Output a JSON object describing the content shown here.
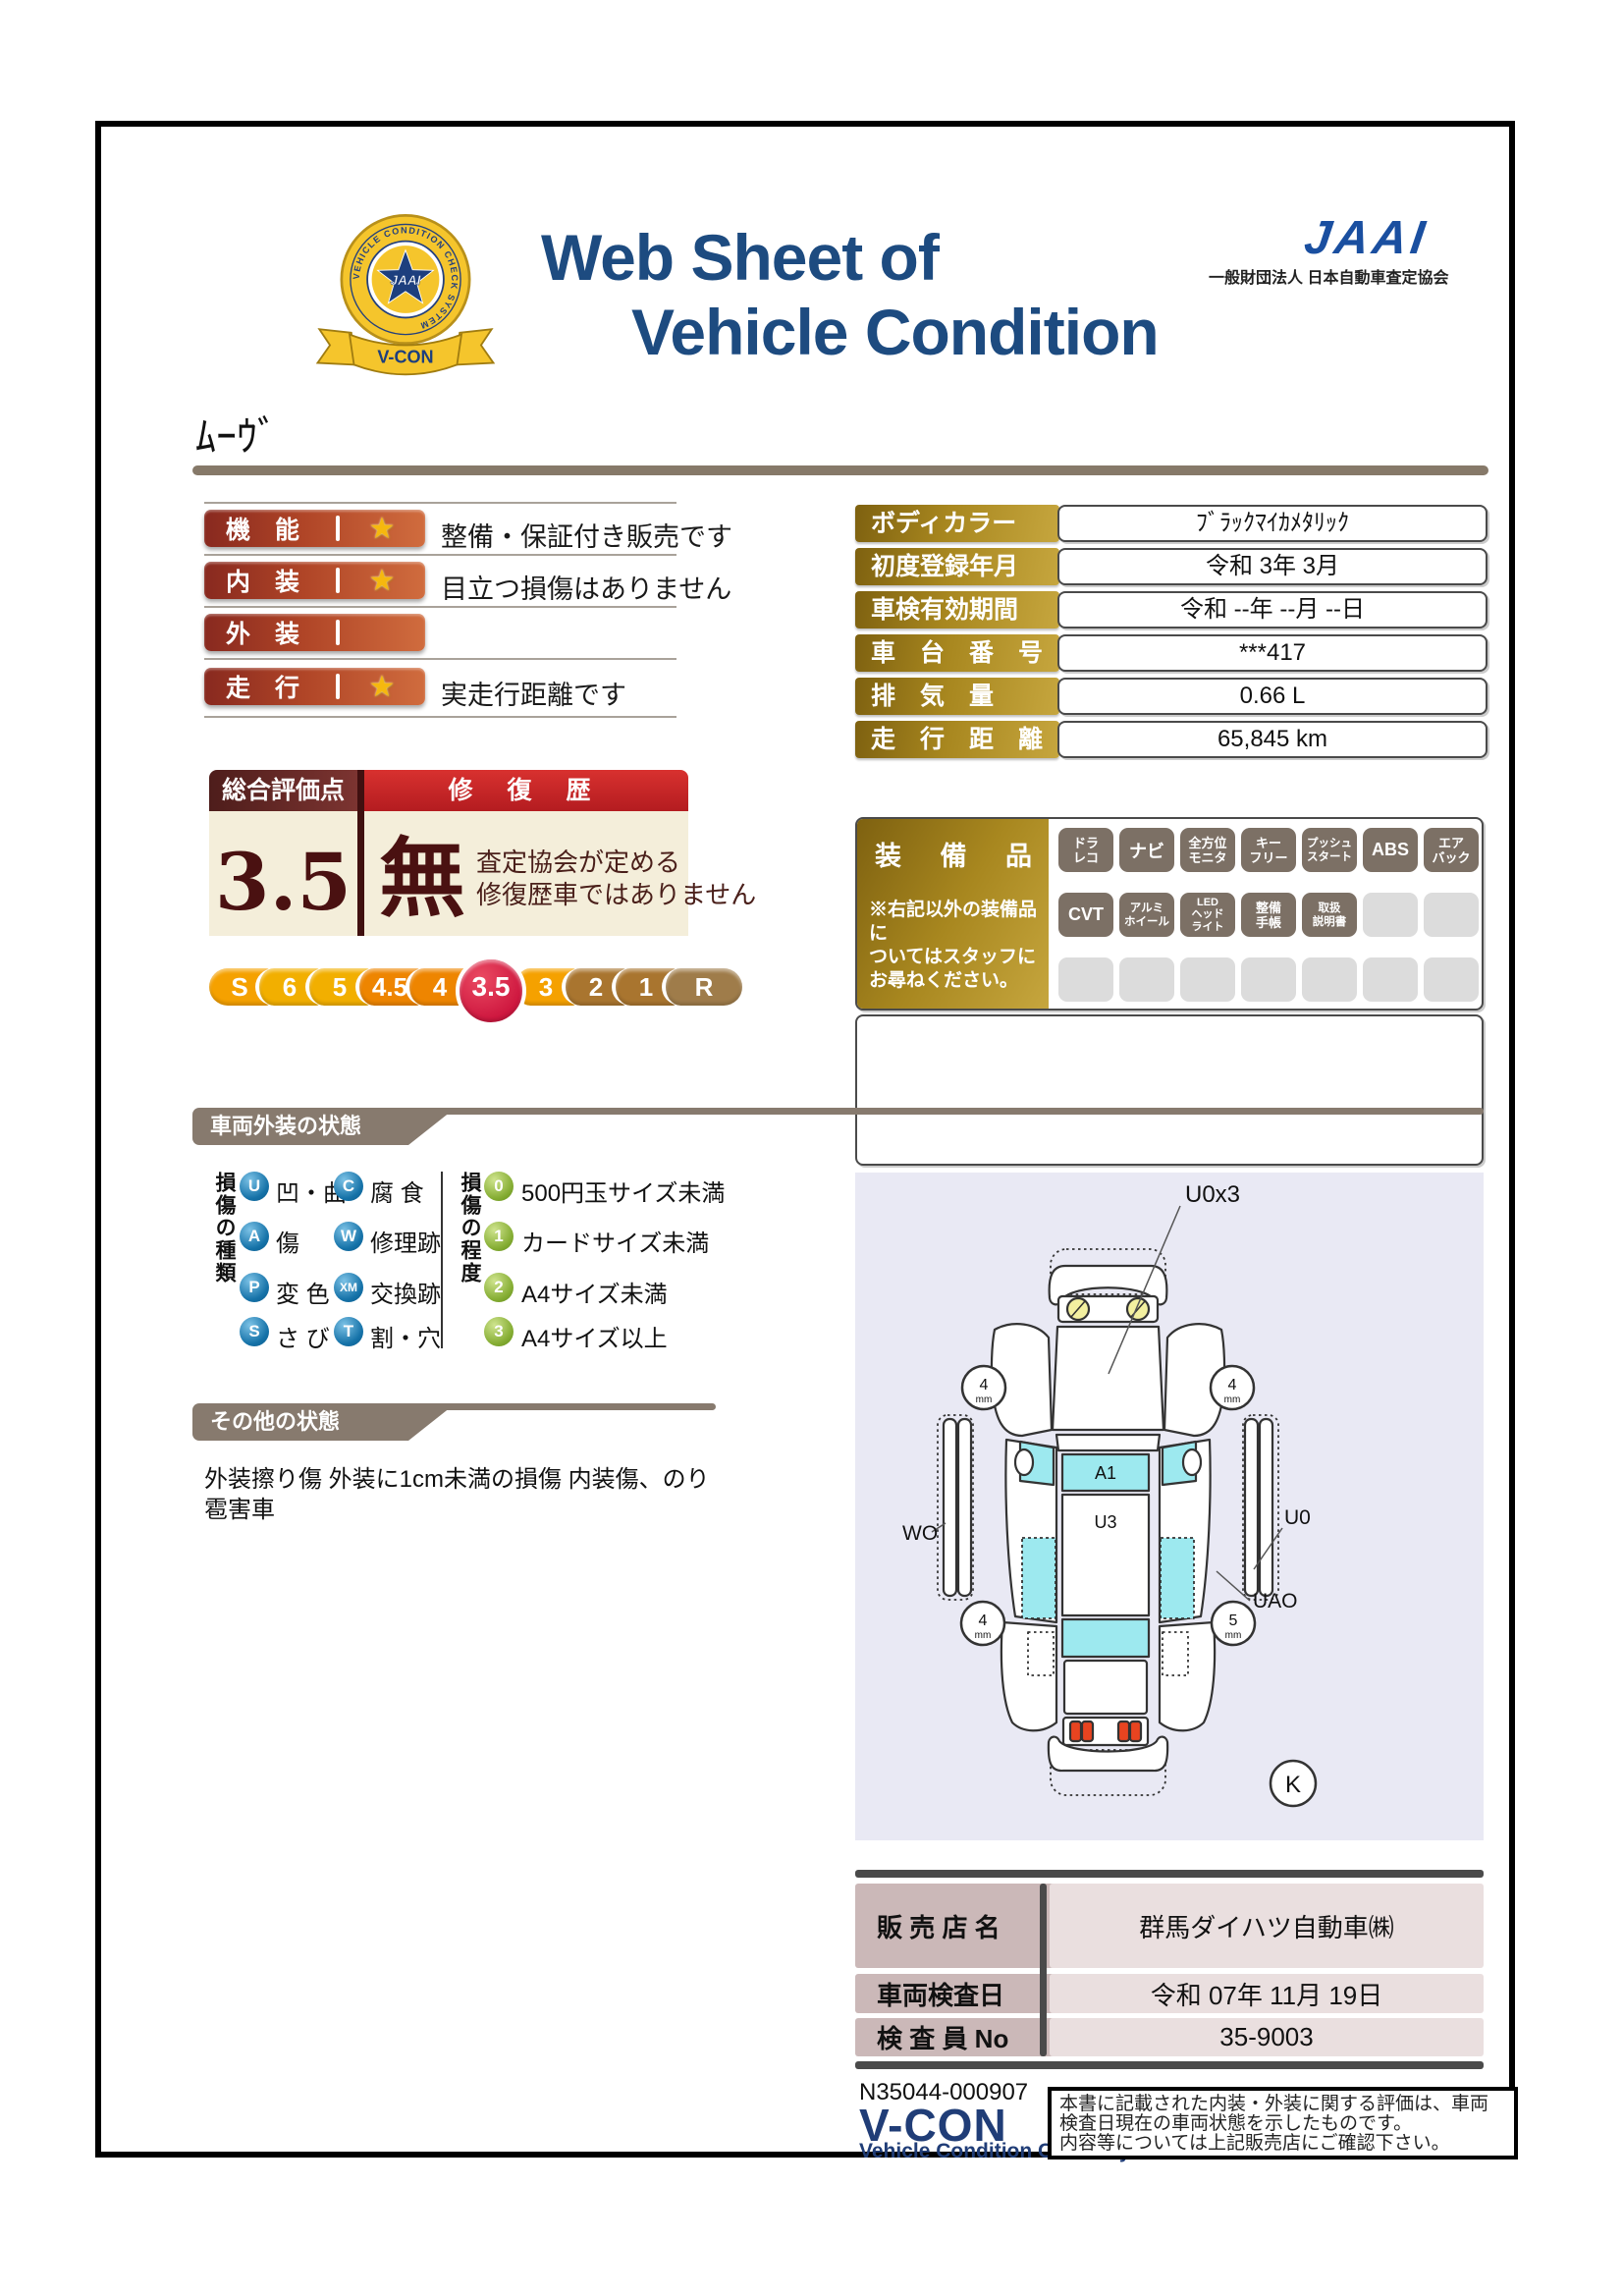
{
  "header": {
    "title1": "Web Sheet of",
    "title2": "Vehicle Condition",
    "jaai_name": "JAAI",
    "jaai_subtitle": "一般財団法人 日本自動車査定協会",
    "emblem": {
      "ring_text": "VEHICLE CONDITION CHECK SYSTEM",
      "center": "JAAI",
      "ribbon": "V-CON"
    }
  },
  "vehicle_name": "ﾑｰｳﾞ",
  "ratings": [
    {
      "label": "機　能",
      "star": "★",
      "description": "整備・保証付き販売です"
    },
    {
      "label": "内　装",
      "star": "★",
      "description": "目立つ損傷はありません"
    },
    {
      "label": "外　装",
      "star": "",
      "description": ""
    },
    {
      "label": "走　行",
      "star": "★",
      "description": "実走行距離です"
    }
  ],
  "overall": {
    "score_label": "総合評価点",
    "score": "3.5",
    "repair_label": "修 復 歴",
    "repair_value": "無",
    "note1": "査定協会が定める",
    "note2": "修復歴車ではありません"
  },
  "scale": {
    "active": "3.5",
    "items": [
      {
        "label": "S"
      },
      {
        "label": "6"
      },
      {
        "label": "5"
      },
      {
        "label": "4.5"
      },
      {
        "label": "4"
      },
      {
        "label": "3.5"
      },
      {
        "label": "3"
      },
      {
        "label": "2"
      },
      {
        "label": "1"
      },
      {
        "label": "R"
      }
    ]
  },
  "details": {
    "rows": [
      {
        "label": "ボディカラー",
        "value": "ﾌﾞﾗｯｸﾏｲｶﾒﾀﾘｯｸ"
      },
      {
        "label": "初度登録年月",
        "value": "令和 3年 3月"
      },
      {
        "label": "車検有効期間",
        "value": "令和 --年 --月 --日"
      },
      {
        "label": "車　台　番　号",
        "value": "***417"
      },
      {
        "label": "排　気　量",
        "value": "0.66 L"
      },
      {
        "label": "走　行　距　離",
        "value": "65,845 km"
      }
    ]
  },
  "equipment": {
    "title": "装 備 品",
    "note1": "※右記以外の装備品に",
    "note2": "ついてはスタッフに",
    "note3": "お尋ねください。",
    "badges": [
      {
        "text": "ドラ\nレコ"
      },
      {
        "text": "ナビ"
      },
      {
        "text": "全方位\nモニタ"
      },
      {
        "text": "キー\nフリー"
      },
      {
        "text": "プッシュ\nスタート"
      },
      {
        "text": "ABS"
      },
      {
        "text": "エア\nバック"
      },
      {
        "text": "CVT"
      },
      {
        "text": "アルミ\nホイール"
      },
      {
        "text": "LED\nヘッド\nライト"
      },
      {
        "text": "整備\n手帳"
      },
      {
        "text": "取扱\n説明書"
      },
      {
        "text": ""
      },
      {
        "text": ""
      },
      {
        "text": ""
      },
      {
        "text": ""
      },
      {
        "text": ""
      },
      {
        "text": ""
      },
      {
        "text": ""
      },
      {
        "text": ""
      },
      {
        "text": ""
      }
    ]
  },
  "exterior": {
    "title": "車両外装の状態",
    "kind_header": "損傷の種類",
    "types": [
      {
        "code": "U",
        "label": "凹・曲"
      },
      {
        "code": "C",
        "label": "腐 食"
      },
      {
        "code": "A",
        "label": "傷"
      },
      {
        "code": "W",
        "label": "修理跡"
      },
      {
        "code": "P",
        "label": "変 色"
      },
      {
        "code": "XM",
        "label": "交換跡"
      },
      {
        "code": "S",
        "label": "さ び"
      },
      {
        "code": "T",
        "label": "割・穴"
      }
    ],
    "degree_header": "損傷の程度",
    "degrees": [
      {
        "code": "0",
        "label": "500円玉サイズ未満"
      },
      {
        "code": "1",
        "label": "カードサイズ未満"
      },
      {
        "code": "2",
        "label": "A4サイズ未満"
      },
      {
        "code": "3",
        "label": "A4サイズ以上"
      }
    ]
  },
  "other": {
    "title": "その他の状態",
    "line1": "外装擦り傷 外装に1cm未満の損傷 内装傷、のり",
    "line2": "雹害車"
  },
  "diagram": {
    "u0x3": "U0x3",
    "a1": "A1",
    "u3": "U3",
    "wo": "WO",
    "u0": "U0",
    "uao": "UAO",
    "k": "K",
    "tires": {
      "fl": "4",
      "fr": "4",
      "rl": "4",
      "rr": "5",
      "unit": "mm"
    }
  },
  "dealer": {
    "rows": [
      {
        "label": "販 売 店 名",
        "value": "群馬ダイハツ自動車㈱"
      },
      {
        "label": "車両検査日",
        "value": "令和 07年 11月 19日"
      },
      {
        "label": "検 査 員 No",
        "value": "35-9003"
      }
    ]
  },
  "footer": {
    "serial": "N35044-000907",
    "vcon": "V-CON",
    "vcon_sub": "Vehicle Condition Check System",
    "disc1": "本書に記載された内装・外装に関する評価は、車両",
    "disc2": "検査日現在の車両状態を示したものです。",
    "disc3": "内容等については上記販売店にご確認下さい。"
  },
  "palette": {
    "title_navy": "#1d4b80",
    "jaai_blue": "#1a4fa0",
    "bar_red_dark": "#88291f",
    "bar_red_light": "#d06c3e",
    "header_maroon": "#4e1d1b",
    "header_red": "#c9232a",
    "beige": "#f4eeda",
    "score_maroon": "#4a1111",
    "gold_dark": "#7e6110",
    "gold_light": "#c6a63e",
    "banner_gray": "#877a6e",
    "badge_gray": "#7c7065",
    "type_blue": "#1572a8",
    "degree_green": "#85ad33",
    "diagram_bg": "#e9e9f4",
    "damage_cyan": "#9de9ef",
    "scale_crimson": "#ce173f",
    "dealer_label_pink": "#cbb8b8",
    "dealer_value_pink": "#eadfdf",
    "star_gold": "#f6b80e",
    "taillight_red": "#e84420",
    "headlight_yellow": "#f3f0a0"
  }
}
